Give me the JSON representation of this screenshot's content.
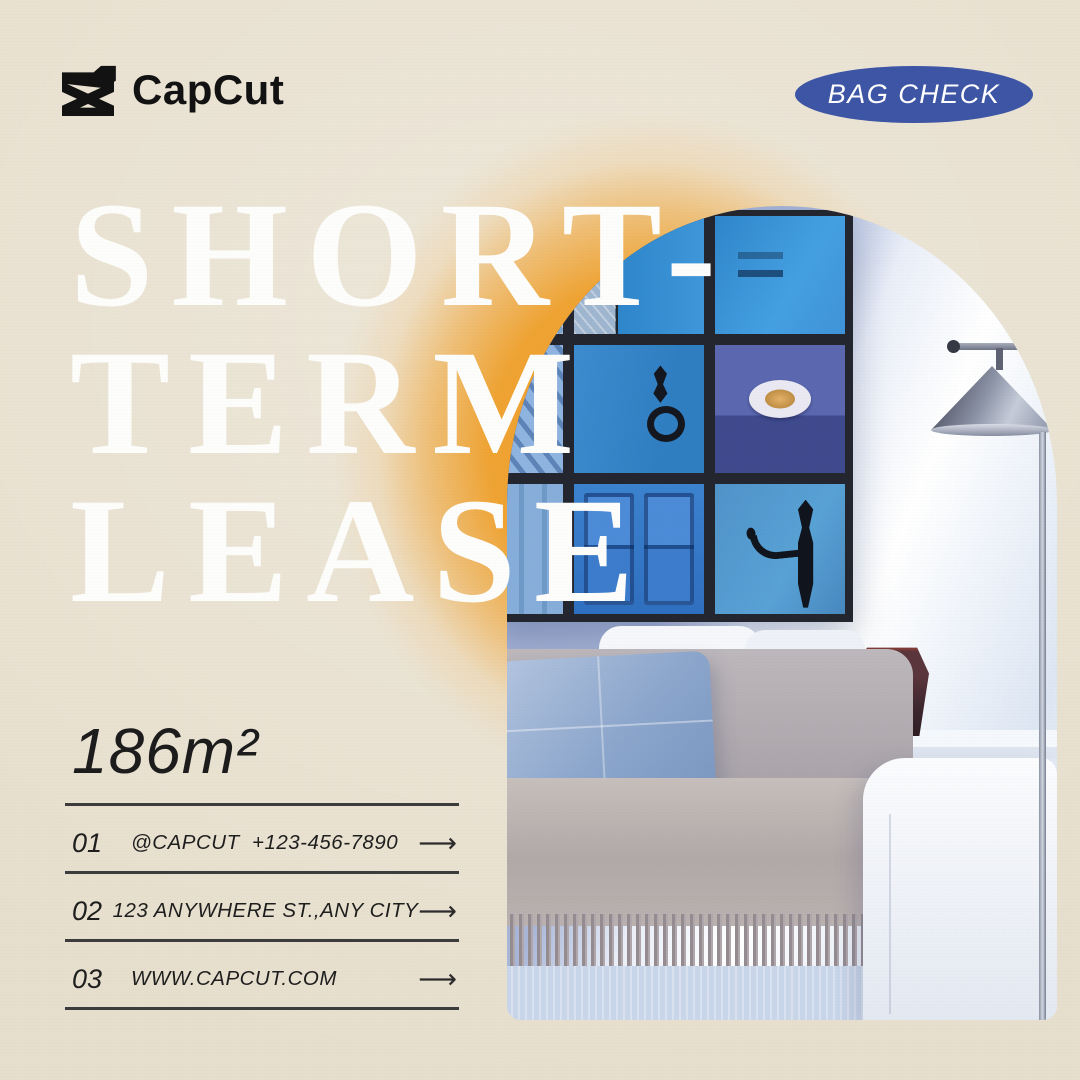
{
  "brand": {
    "wordmark": "CapCut",
    "logo_icon": "capcut-clapper-icon"
  },
  "badge": {
    "label": "BAG CHECK",
    "bg_color": "#3D55A5",
    "text_color": "#FFFFFF"
  },
  "headline": {
    "lines": [
      "SHORT-",
      "TERM",
      "LEASE"
    ],
    "color": "#FFFFFF"
  },
  "area_label": "186m²",
  "contacts": [
    {
      "num": "01",
      "text": "@CAPCUT  +123-456-7890"
    },
    {
      "num": "02",
      "text": "123 ANYWHERE ST.,ANY CITY"
    },
    {
      "num": "03",
      "text": "WWW.CAPCUT.COM"
    }
  ],
  "icons": {
    "arrow_right": "⟶"
  },
  "colors": {
    "background": "#E7DFCD",
    "accent_orange": "#EFA12C",
    "badge_blue": "#3D55A5",
    "text_dark": "#1F1F1F",
    "divider": "#3C3C3C",
    "headline_white": "#FDFDFB"
  }
}
